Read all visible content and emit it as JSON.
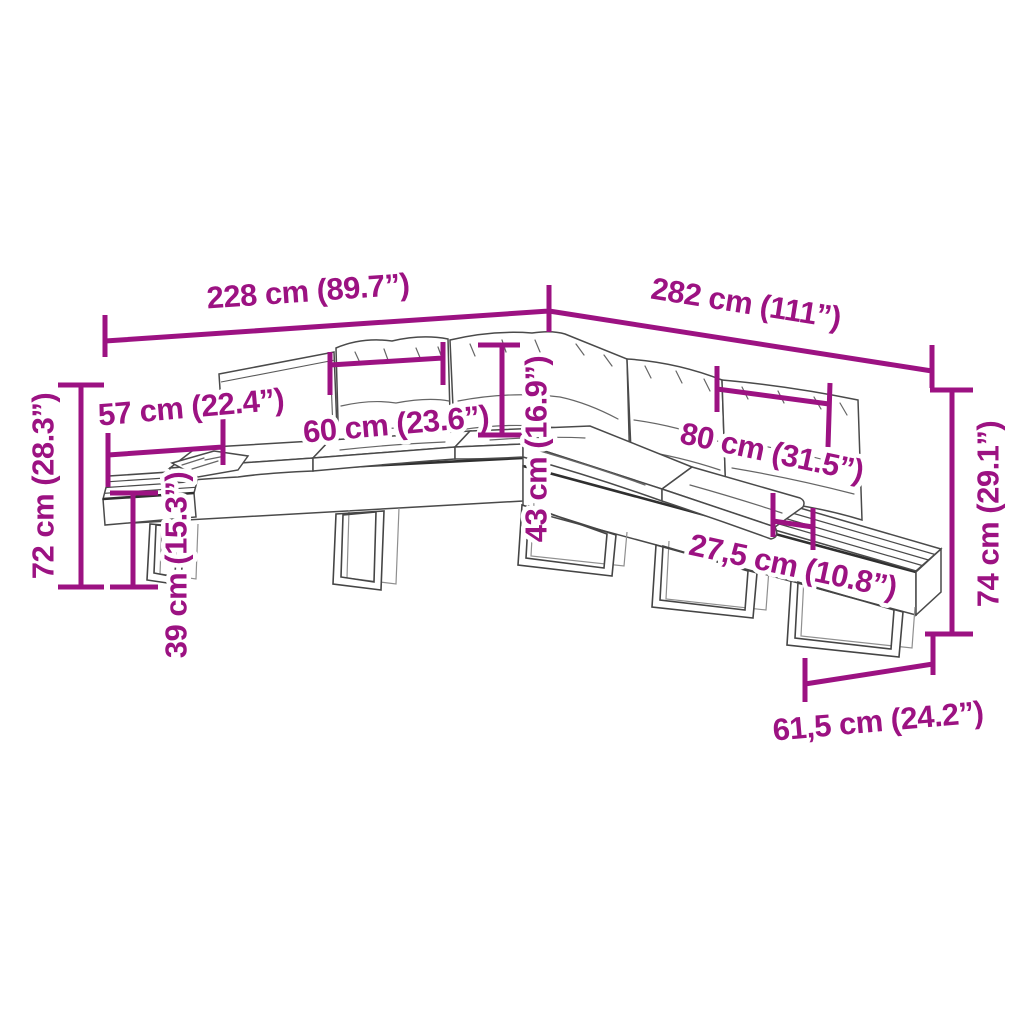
{
  "diagram": {
    "kind": "product-dimension-diagram",
    "subject": "L-shaped poly rattan garden sofa set with cushions and slatted end tables",
    "colors": {
      "dimension_accent": "#9C1282",
      "drawing_line": "#4a4a4a",
      "background": "#ffffff"
    },
    "dims": {
      "back_width_left": {
        "label": "228 cm (89.7”)"
      },
      "back_width_right": {
        "label": "282 cm (111”)"
      },
      "left_end_depth": {
        "label": "57 cm (22.4”)"
      },
      "cushion_width": {
        "label": "60 cm (23.6”)"
      },
      "backrest_height": {
        "label": "43 cm (16.9”)"
      },
      "right_cushion_width": {
        "label": "80 cm (31.5”)"
      },
      "table_ledge_width": {
        "label": "27,5 cm (10.8”)"
      },
      "total_height_left": {
        "label": "72 cm (28.3”)"
      },
      "seat_height": {
        "label": "39 cm (15.3”)"
      },
      "total_height_right": {
        "label": "74 cm (29.1”)"
      },
      "right_end_depth": {
        "label": "61,5 cm (24.2”)"
      }
    }
  }
}
